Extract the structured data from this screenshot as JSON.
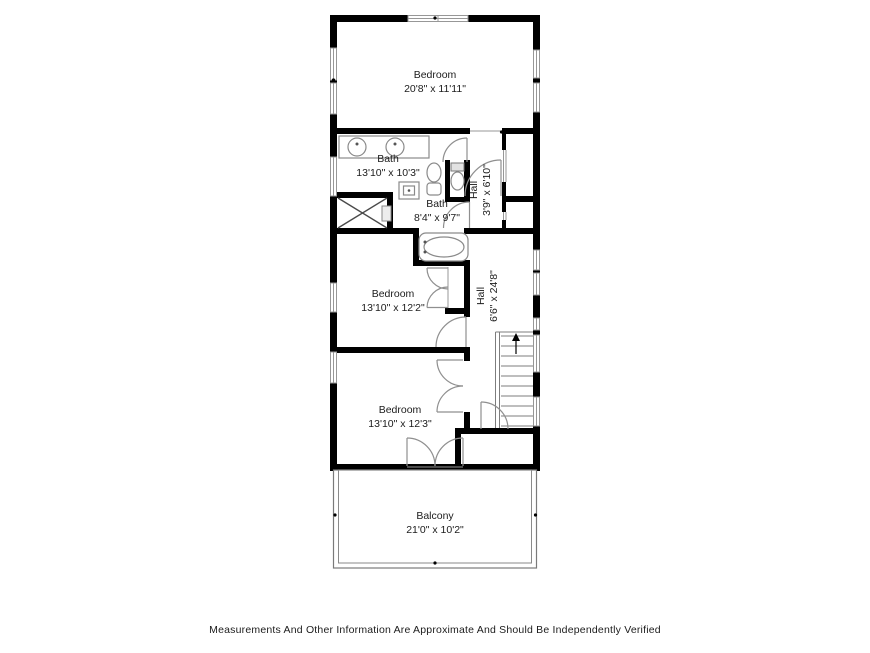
{
  "title": "Floor Plan",
  "rooms": [
    {
      "id": "bedroom-top",
      "name": "Bedroom",
      "dims": "20'8\" x 11'11\""
    },
    {
      "id": "bath-main",
      "name": "Bath",
      "dims": "13'10\" x 10'3\""
    },
    {
      "id": "hall-small",
      "name": "Hall",
      "dims": "3'9\" x 6'10\""
    },
    {
      "id": "bath-small",
      "name": "Bath",
      "dims": "8'4\" x 9'7\""
    },
    {
      "id": "bedroom-middle",
      "name": "Bedroom",
      "dims": "13'10\" x 12'2\""
    },
    {
      "id": "hall-long",
      "name": "Hall",
      "dims": "6'6\" x 24'8\""
    },
    {
      "id": "bedroom-bottom",
      "name": "Bedroom",
      "dims": "13'10\" x 12'3\""
    },
    {
      "id": "balcony",
      "name": "Balcony",
      "dims": "21'0\" x 10'2\""
    }
  ],
  "disclaimer": "Measurements And Other Information Are Approximate And Should Be Independently Verified",
  "colors": {
    "wall": "#000000",
    "window_frame": "#979797",
    "fixture_stroke": "#8a8a8a",
    "text": "#1c1c1c",
    "background": "#ffffff"
  }
}
